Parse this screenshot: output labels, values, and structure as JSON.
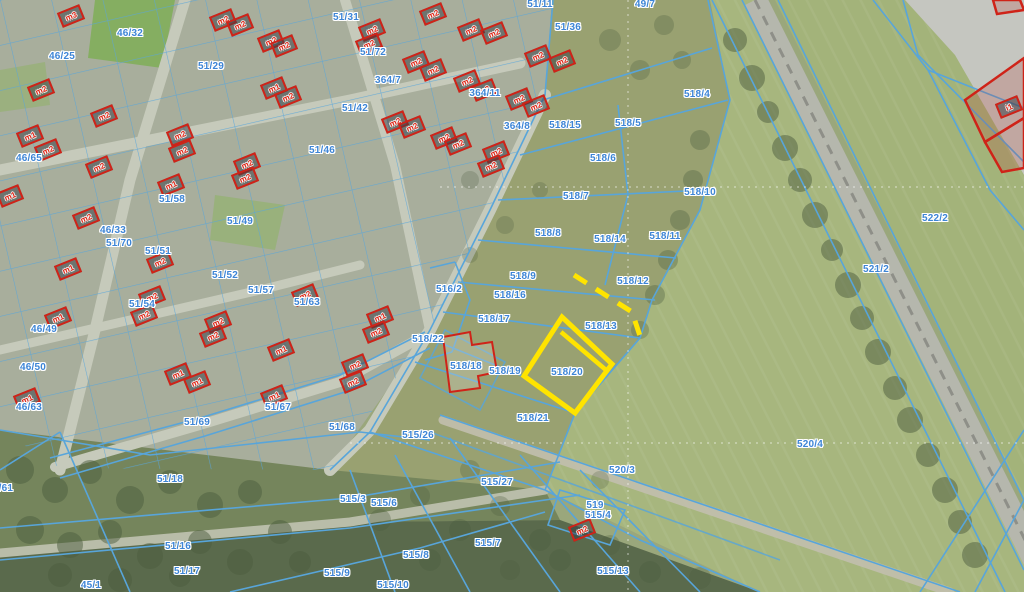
{
  "map": {
    "description": "Cadastral aerial map with parcel boundaries, building outlines and a highlighted parcel",
    "colors": {
      "parcel_line_blue": "#58a5da",
      "parcel_label_blue": "#3d85d6",
      "building_red": "#cf2318",
      "highlight_yellow": "#ffe400",
      "road_gray": "#c6cabb",
      "field_green": "#a7b67e",
      "woods_green": "#5a6a4c"
    },
    "highlight": {
      "parcel_id": "518/20",
      "style": "solid-outline"
    },
    "highlight_secondary": {
      "parcel_id": "518/13",
      "style": "dashed-outline"
    },
    "parcels": [
      {
        "id": "46/32",
        "x": 130,
        "y": 34
      },
      {
        "id": "46/25",
        "x": 62,
        "y": 57
      },
      {
        "id": "51/29",
        "x": 211,
        "y": 67
      },
      {
        "id": "46/65",
        "x": 29,
        "y": 159
      },
      {
        "id": "51/46",
        "x": 322,
        "y": 151
      },
      {
        "id": "51/31",
        "x": 346,
        "y": 18
      },
      {
        "id": "51/72",
        "x": 373,
        "y": 53
      },
      {
        "id": "364/7",
        "x": 388,
        "y": 81
      },
      {
        "id": "51/42",
        "x": 355,
        "y": 109
      },
      {
        "id": "364/11",
        "x": 485,
        "y": 94
      },
      {
        "id": "364/8",
        "x": 517,
        "y": 127
      },
      {
        "id": "518/15",
        "x": 565,
        "y": 126
      },
      {
        "id": "51/36",
        "x": 568,
        "y": 28
      },
      {
        "id": "51/11",
        "x": 540,
        "y": 5
      },
      {
        "id": "49/7",
        "x": 645,
        "y": 5
      },
      {
        "id": "518/4",
        "x": 697,
        "y": 95
      },
      {
        "id": "518/5",
        "x": 628,
        "y": 124
      },
      {
        "id": "518/6",
        "x": 603,
        "y": 159
      },
      {
        "id": "518/7",
        "x": 576,
        "y": 197
      },
      {
        "id": "518/8",
        "x": 548,
        "y": 234
      },
      {
        "id": "518/14",
        "x": 610,
        "y": 240
      },
      {
        "id": "518/11",
        "x": 665,
        "y": 237
      },
      {
        "id": "518/10",
        "x": 700,
        "y": 193
      },
      {
        "id": "518/9",
        "x": 523,
        "y": 277
      },
      {
        "id": "518/12",
        "x": 633,
        "y": 282
      },
      {
        "id": "518/16",
        "x": 510,
        "y": 296
      },
      {
        "id": "518/17",
        "x": 494,
        "y": 320
      },
      {
        "id": "516/2",
        "x": 449,
        "y": 290
      },
      {
        "id": "518/22",
        "x": 428,
        "y": 340
      },
      {
        "id": "518/18",
        "x": 466,
        "y": 367
      },
      {
        "id": "518/19",
        "x": 505,
        "y": 372
      },
      {
        "id": "518/20",
        "x": 567,
        "y": 373
      },
      {
        "id": "518/13",
        "x": 601,
        "y": 327
      },
      {
        "id": "518/21",
        "x": 533,
        "y": 419
      },
      {
        "id": "46/33",
        "x": 113,
        "y": 231
      },
      {
        "id": "51/70",
        "x": 119,
        "y": 244
      },
      {
        "id": "51/58",
        "x": 172,
        "y": 200
      },
      {
        "id": "51/49",
        "x": 240,
        "y": 222
      },
      {
        "id": "51/51",
        "x": 158,
        "y": 252
      },
      {
        "id": "51/52",
        "x": 225,
        "y": 276
      },
      {
        "id": "51/57",
        "x": 261,
        "y": 291
      },
      {
        "id": "51/54",
        "x": 142,
        "y": 305
      },
      {
        "id": "46/49",
        "x": 44,
        "y": 330
      },
      {
        "id": "46/50",
        "x": 33,
        "y": 368
      },
      {
        "id": "51/63",
        "x": 307,
        "y": 303
      },
      {
        "id": "51/67",
        "x": 278,
        "y": 408
      },
      {
        "id": "51/69",
        "x": 197,
        "y": 423
      },
      {
        "id": "51/68",
        "x": 342,
        "y": 428
      },
      {
        "id": "515/26",
        "x": 418,
        "y": 436
      },
      {
        "id": "46/63",
        "x": 29,
        "y": 408
      },
      {
        "id": "51/18",
        "x": 170,
        "y": 480
      },
      {
        "id": "51/16",
        "x": 178,
        "y": 547
      },
      {
        "id": "51/17",
        "x": 187,
        "y": 572
      },
      {
        "id": "45/1",
        "x": 91,
        "y": 586
      },
      {
        "id": "1/61",
        "x": 3,
        "y": 489
      },
      {
        "id": "515/27",
        "x": 497,
        "y": 483
      },
      {
        "id": "515/6",
        "x": 384,
        "y": 504
      },
      {
        "id": "515/3",
        "x": 353,
        "y": 500
      },
      {
        "id": "515/7",
        "x": 488,
        "y": 544
      },
      {
        "id": "515/8",
        "x": 416,
        "y": 556
      },
      {
        "id": "515/9",
        "x": 337,
        "y": 574
      },
      {
        "id": "515/10",
        "x": 393,
        "y": 586
      },
      {
        "id": "519",
        "x": 595,
        "y": 506
      },
      {
        "id": "515/4",
        "x": 598,
        "y": 516
      },
      {
        "id": "520/3",
        "x": 622,
        "y": 471
      },
      {
        "id": "520/4",
        "x": 810,
        "y": 445
      },
      {
        "id": "515/13",
        "x": 613,
        "y": 572
      },
      {
        "id": "521/2",
        "x": 876,
        "y": 270
      },
      {
        "id": "522/2",
        "x": 935,
        "y": 219
      }
    ],
    "buildings": [
      {
        "id": "m3",
        "x": 71,
        "y": 16
      },
      {
        "id": "m2",
        "x": 223,
        "y": 20
      },
      {
        "id": "m2",
        "x": 240,
        "y": 25
      },
      {
        "id": "m2",
        "x": 271,
        "y": 41
      },
      {
        "id": "m2",
        "x": 284,
        "y": 46
      },
      {
        "id": "m1",
        "x": 274,
        "y": 88
      },
      {
        "id": "m2",
        "x": 288,
        "y": 97
      },
      {
        "id": "m2",
        "x": 41,
        "y": 90
      },
      {
        "id": "m2",
        "x": 104,
        "y": 116
      },
      {
        "id": "m1",
        "x": 30,
        "y": 136
      },
      {
        "id": "m2",
        "x": 48,
        "y": 150
      },
      {
        "id": "m2",
        "x": 99,
        "y": 167
      },
      {
        "id": "m2",
        "x": 180,
        "y": 135
      },
      {
        "id": "m2",
        "x": 182,
        "y": 151
      },
      {
        "id": "m2",
        "x": 247,
        "y": 164
      },
      {
        "id": "m2",
        "x": 245,
        "y": 178
      },
      {
        "id": "m1",
        "x": 171,
        "y": 185
      },
      {
        "id": "m2",
        "x": 433,
        "y": 14
      },
      {
        "id": "m2",
        "x": 372,
        "y": 30
      },
      {
        "id": "m2",
        "x": 369,
        "y": 44
      },
      {
        "id": "m2",
        "x": 471,
        "y": 30
      },
      {
        "id": "m2",
        "x": 494,
        "y": 33
      },
      {
        "id": "m2",
        "x": 416,
        "y": 62
      },
      {
        "id": "m2",
        "x": 433,
        "y": 70
      },
      {
        "id": "m2",
        "x": 538,
        "y": 56
      },
      {
        "id": "m2",
        "x": 562,
        "y": 61
      },
      {
        "id": "m2",
        "x": 467,
        "y": 81
      },
      {
        "id": "m2",
        "x": 484,
        "y": 90
      },
      {
        "id": "m2",
        "x": 519,
        "y": 99
      },
      {
        "id": "m2",
        "x": 536,
        "y": 106
      },
      {
        "id": "m2",
        "x": 395,
        "y": 122
      },
      {
        "id": "m2",
        "x": 412,
        "y": 127
      },
      {
        "id": "m2",
        "x": 444,
        "y": 138
      },
      {
        "id": "m2",
        "x": 458,
        "y": 144
      },
      {
        "id": "m2",
        "x": 496,
        "y": 152
      },
      {
        "id": "m2",
        "x": 491,
        "y": 166
      },
      {
        "id": "m1",
        "x": 10,
        "y": 196
      },
      {
        "id": "m2",
        "x": 86,
        "y": 218
      },
      {
        "id": "m1",
        "x": 68,
        "y": 269
      },
      {
        "id": "m1",
        "x": 58,
        "y": 318
      },
      {
        "id": "m2",
        "x": 160,
        "y": 262
      },
      {
        "id": "m2",
        "x": 152,
        "y": 297
      },
      {
        "id": "m2",
        "x": 144,
        "y": 315
      },
      {
        "id": "m2",
        "x": 218,
        "y": 322
      },
      {
        "id": "m2",
        "x": 213,
        "y": 336
      },
      {
        "id": "m2",
        "x": 305,
        "y": 295
      },
      {
        "id": "m1",
        "x": 281,
        "y": 350
      },
      {
        "id": "m1",
        "x": 274,
        "y": 396
      },
      {
        "id": "m2",
        "x": 355,
        "y": 365
      },
      {
        "id": "m2",
        "x": 353,
        "y": 382
      },
      {
        "id": "m1",
        "x": 178,
        "y": 374
      },
      {
        "id": "m1",
        "x": 197,
        "y": 382
      },
      {
        "id": "m1",
        "x": 27,
        "y": 399
      },
      {
        "id": "m1",
        "x": 380,
        "y": 317
      },
      {
        "id": "m2",
        "x": 376,
        "y": 332
      },
      {
        "id": "m2",
        "x": 582,
        "y": 530
      },
      {
        "id": "i1",
        "x": 1009,
        "y": 107
      }
    ]
  }
}
